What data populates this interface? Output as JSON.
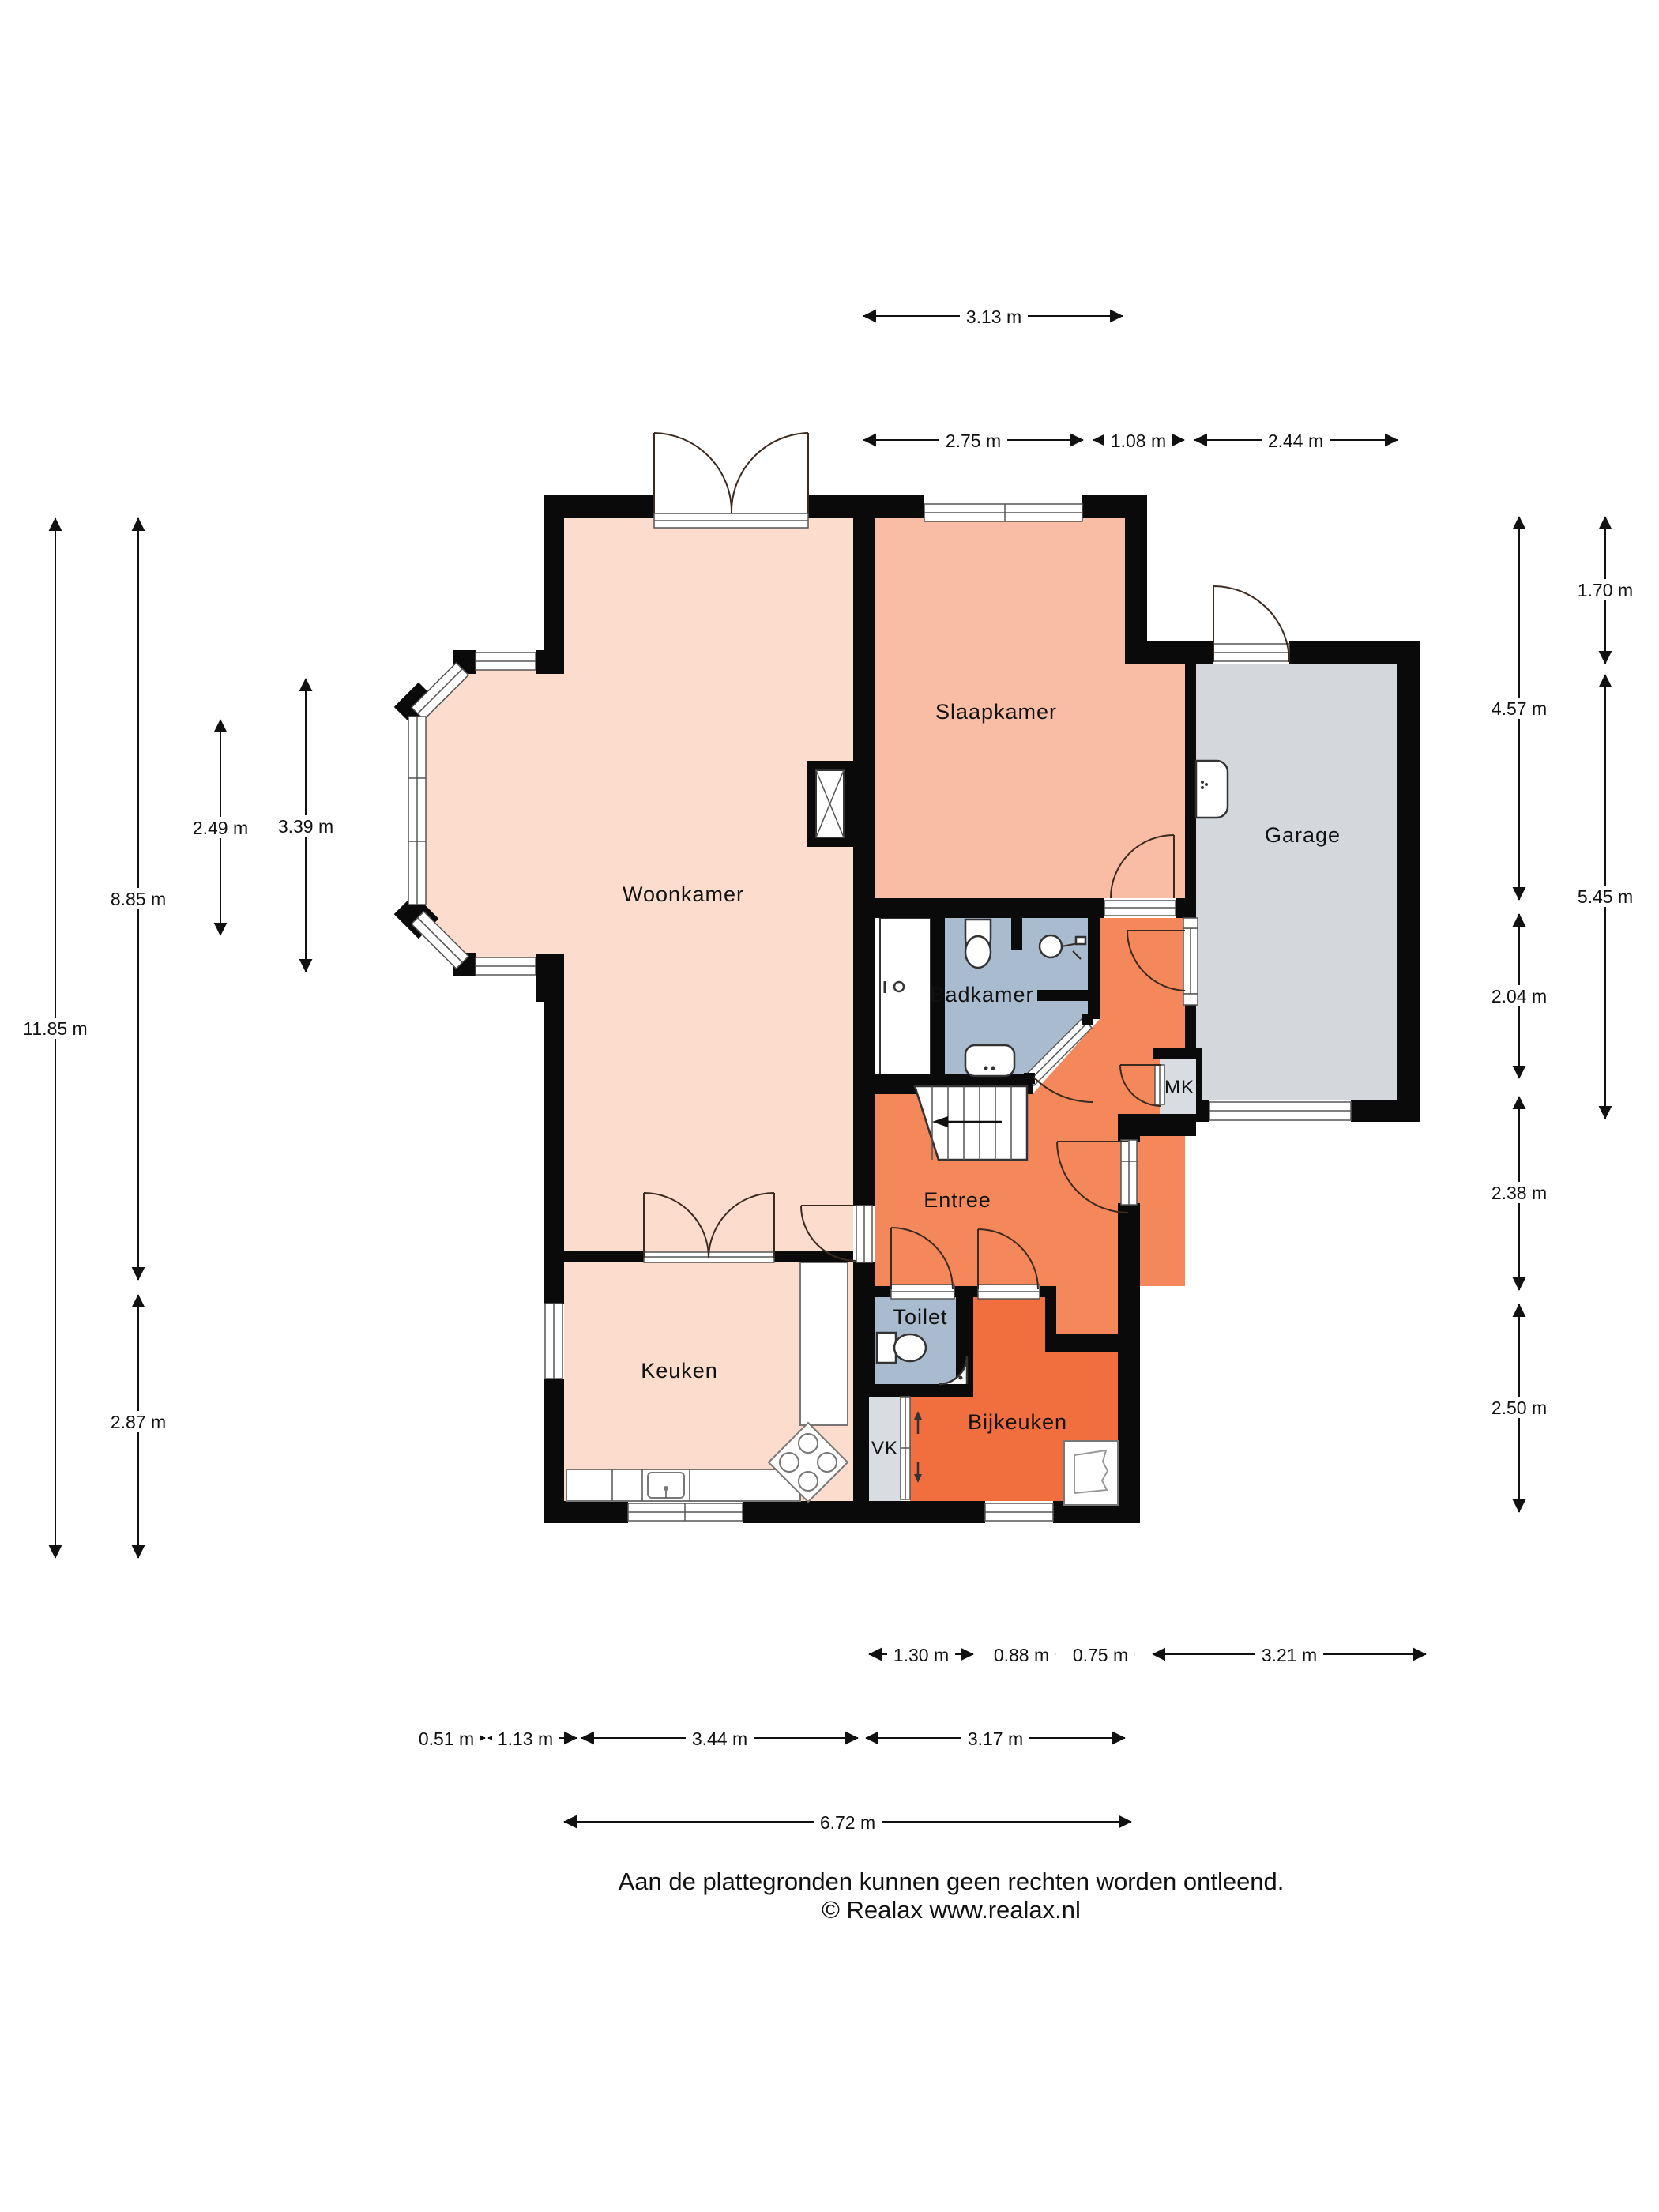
{
  "floorplan": {
    "rooms": {
      "woonkamer": "Woonkamer",
      "slaapkamer": "Slaapkamer",
      "garage": "Garage",
      "badkamer": "Badkamer",
      "entree": "Entree",
      "toilet": "Toilet",
      "bijkeuken": "Bijkeuken",
      "keuken": "Keuken",
      "mk": "MK",
      "vk": "VK"
    },
    "colors": {
      "woonkamer": "#fbdccd",
      "keuken": "#fbdccd",
      "slaapkamer": "#f8bda4",
      "entree": "#f5885a",
      "bijkeuken": "#f16f3e",
      "sanitary": "#a9bbce",
      "garage": "#d4d8dd",
      "closet": "#d9dde2",
      "wall": "#0a0a0a"
    },
    "dims": {
      "t1": "3.13 m",
      "t2": "2.75 m",
      "t3": "1.08 m",
      "t4": "2.44 m",
      "l1": "11.85 m",
      "l2": "8.85 m",
      "l3": "2.87 m",
      "l4": "2.49 m",
      "l5": "3.39 m",
      "r1": "4.57 m",
      "r2": "2.04 m",
      "r3": "2.38 m",
      "r4": "2.50 m",
      "r5": "1.70 m",
      "r6": "5.45 m",
      "b1": "1.30 m",
      "b2": "0.88 m",
      "b3": "0.75 m",
      "b4": "3.21 m",
      "b5": "0.51 m",
      "b6": "1.13 m",
      "b7": "3.44 m",
      "b8": "3.17 m",
      "b9": "6.72 m"
    },
    "footer": {
      "line1": "Aan de plattegronden kunnen geen rechten worden ontleend.",
      "line2": "© Realax www.realax.nl"
    }
  }
}
